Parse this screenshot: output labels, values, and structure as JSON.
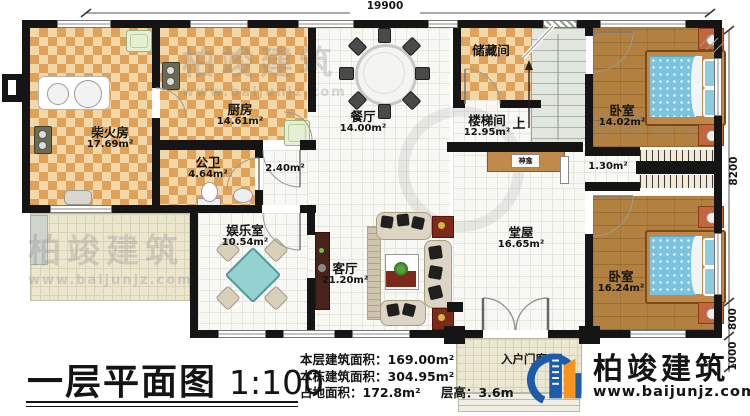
{
  "plan": {
    "dimensions": {
      "top": "19900",
      "right_main": "8200",
      "right_mid": "800",
      "right_porch": "1000"
    },
    "rooms": {
      "chaihuofang": {
        "name": "柴火房",
        "area": "17.69m²"
      },
      "chufang": {
        "name": "厨房",
        "area": "14.61m²"
      },
      "gongwei": {
        "name": "公卫",
        "area": "4.64m²"
      },
      "guodao": {
        "area": "2.40m²"
      },
      "canting": {
        "name": "餐厅",
        "area": "14.00m²"
      },
      "chucangjian": {
        "name": "储藏间"
      },
      "loutijian": {
        "name": "楼梯间",
        "area": "12.95m²",
        "up": "上"
      },
      "shenkan": {
        "name": "神龛"
      },
      "woshi_top": {
        "name": "卧室",
        "area": "14.02m²"
      },
      "yigui": {
        "area": "1.30m²"
      },
      "woshi_bottom": {
        "name": "卧室",
        "area": "16.24m²"
      },
      "tangwu": {
        "name": "堂屋",
        "area": "16.65m²"
      },
      "keting": {
        "name": "客厅",
        "area": "21.20m²"
      },
      "yuleshi": {
        "name": "娱乐室",
        "area": "10.54m²"
      },
      "menlang": {
        "name": "入户门廊"
      }
    }
  },
  "title_block": {
    "title": "一层平面图",
    "scale": "1:100",
    "stats": [
      {
        "label": "本层建筑面积：",
        "value": "169.00m²"
      },
      {
        "label": "本栋建筑面积：",
        "value": "304.95m²"
      },
      {
        "label": "占地面积：",
        "value": "172.8m²"
      },
      {
        "label": "层高：",
        "value": "3.6m"
      }
    ]
  },
  "brand": {
    "name": "柏竣建筑",
    "website": "www.baijunjz.com"
  },
  "watermark": {
    "name": "柏竣建筑",
    "website": "www.baijunjz.com"
  },
  "colors": {
    "logo_blue": "#1c5cab",
    "logo_orange": "#f7941e",
    "wall": "#151515",
    "bed_blue": "#7cc4dd"
  }
}
